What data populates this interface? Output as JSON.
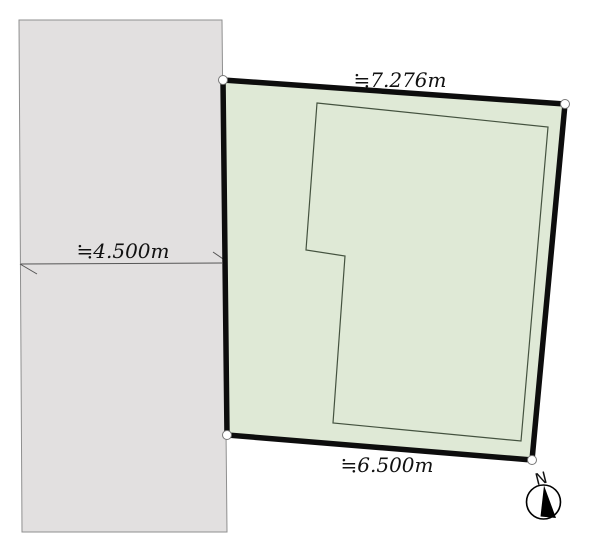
{
  "diagram": {
    "type": "land-plot-site-plan",
    "labels": {
      "top_edge_dimension": "≒7.276m",
      "bottom_edge_dimension": "≒6.500m",
      "road_width_dimension": "≒4.500m",
      "compass_north": "N"
    },
    "measurements": {
      "top_edge_m": 7.276,
      "bottom_edge_m": 6.5,
      "road_width_m": 4.5
    }
  },
  "colors": {
    "background": "#ffffff",
    "plot_fill": "#dfe9d6",
    "plot_border": "#0d0d0d",
    "road_fill": "#e2e0e0",
    "road_border": "#8f8f8f",
    "building_outline": "#44523f",
    "dimension_line": "#555555",
    "corner_marker_fill": "#ffffff",
    "corner_marker_stroke": "#777777",
    "text": "#111111",
    "compass_stroke": "#000000",
    "compass_needle": "#000000"
  }
}
